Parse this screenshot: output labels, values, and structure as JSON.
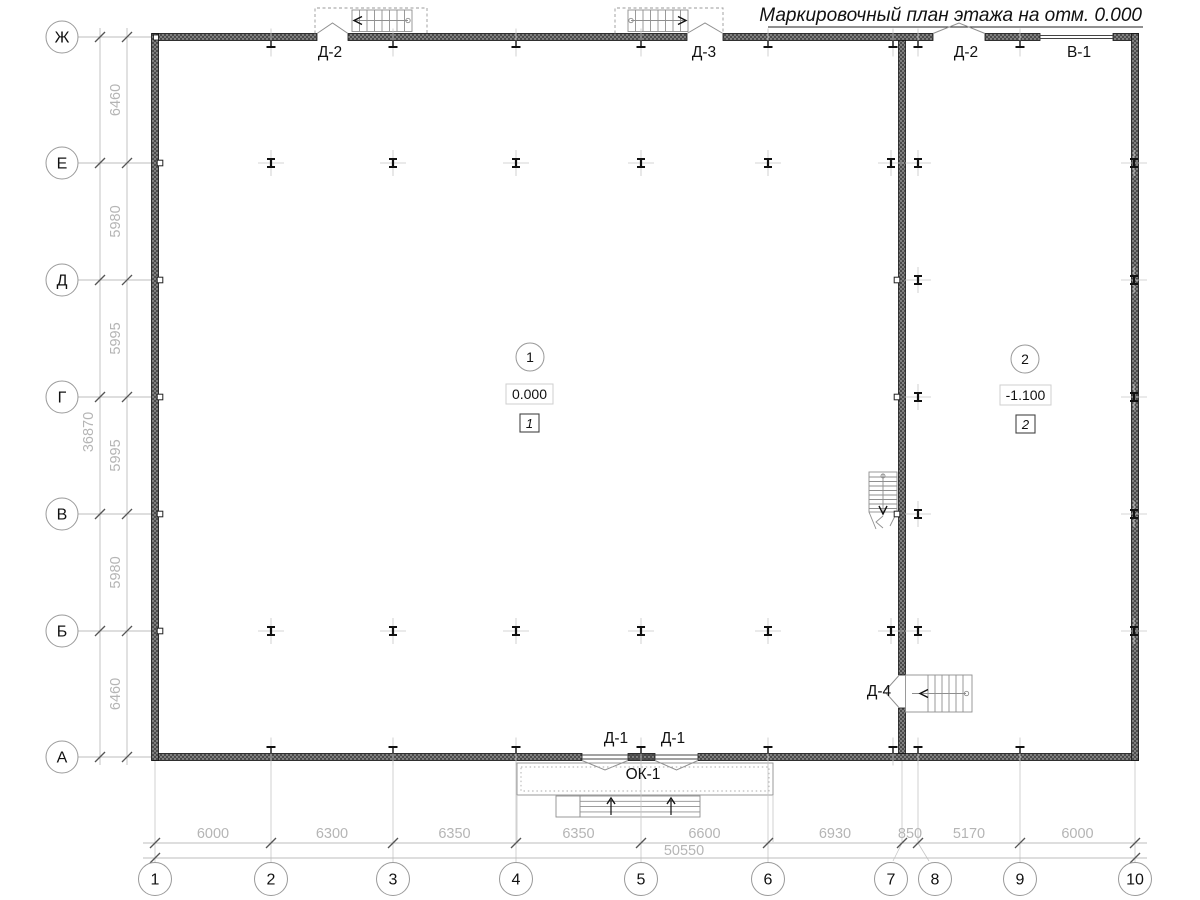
{
  "title": "Маркировочный план этажа на отм. 0.000",
  "grid": {
    "row_labels": [
      "Ж",
      "Е",
      "Д",
      "Г",
      "В",
      "Б",
      "А"
    ],
    "row_dims": [
      "6460",
      "5980",
      "5995",
      "5995",
      "5980",
      "6460"
    ],
    "row_total": "36870",
    "col_labels": [
      "1",
      "2",
      "3",
      "4",
      "5",
      "6",
      "7",
      "8",
      "9",
      "10"
    ],
    "col_dims": [
      "6000",
      "6300",
      "6350",
      "6350",
      "6600",
      "6930",
      "850",
      "5170",
      "6000"
    ],
    "col_total": "50550"
  },
  "marks": {
    "top_door_left": "Д-2",
    "top_door_mid": "Д-3",
    "top_door_right": "Д-2",
    "top_window": "В-1",
    "bottom_door_left": "Д-1",
    "bottom_door_right": "Д-1",
    "bottom_window": "ОК-1",
    "right_door": "Д-4"
  },
  "rooms": [
    {
      "number": "1",
      "elevation": "0.000",
      "type_mark": "1"
    },
    {
      "number": "2",
      "elevation": "-1.100",
      "type_mark": "2"
    }
  ],
  "colors": {
    "line": "#111111",
    "wall_fill": "#4a4a4a",
    "grid_line": "#c6c6c6",
    "dim_text": "#b5b5b5",
    "background": "#ffffff"
  }
}
